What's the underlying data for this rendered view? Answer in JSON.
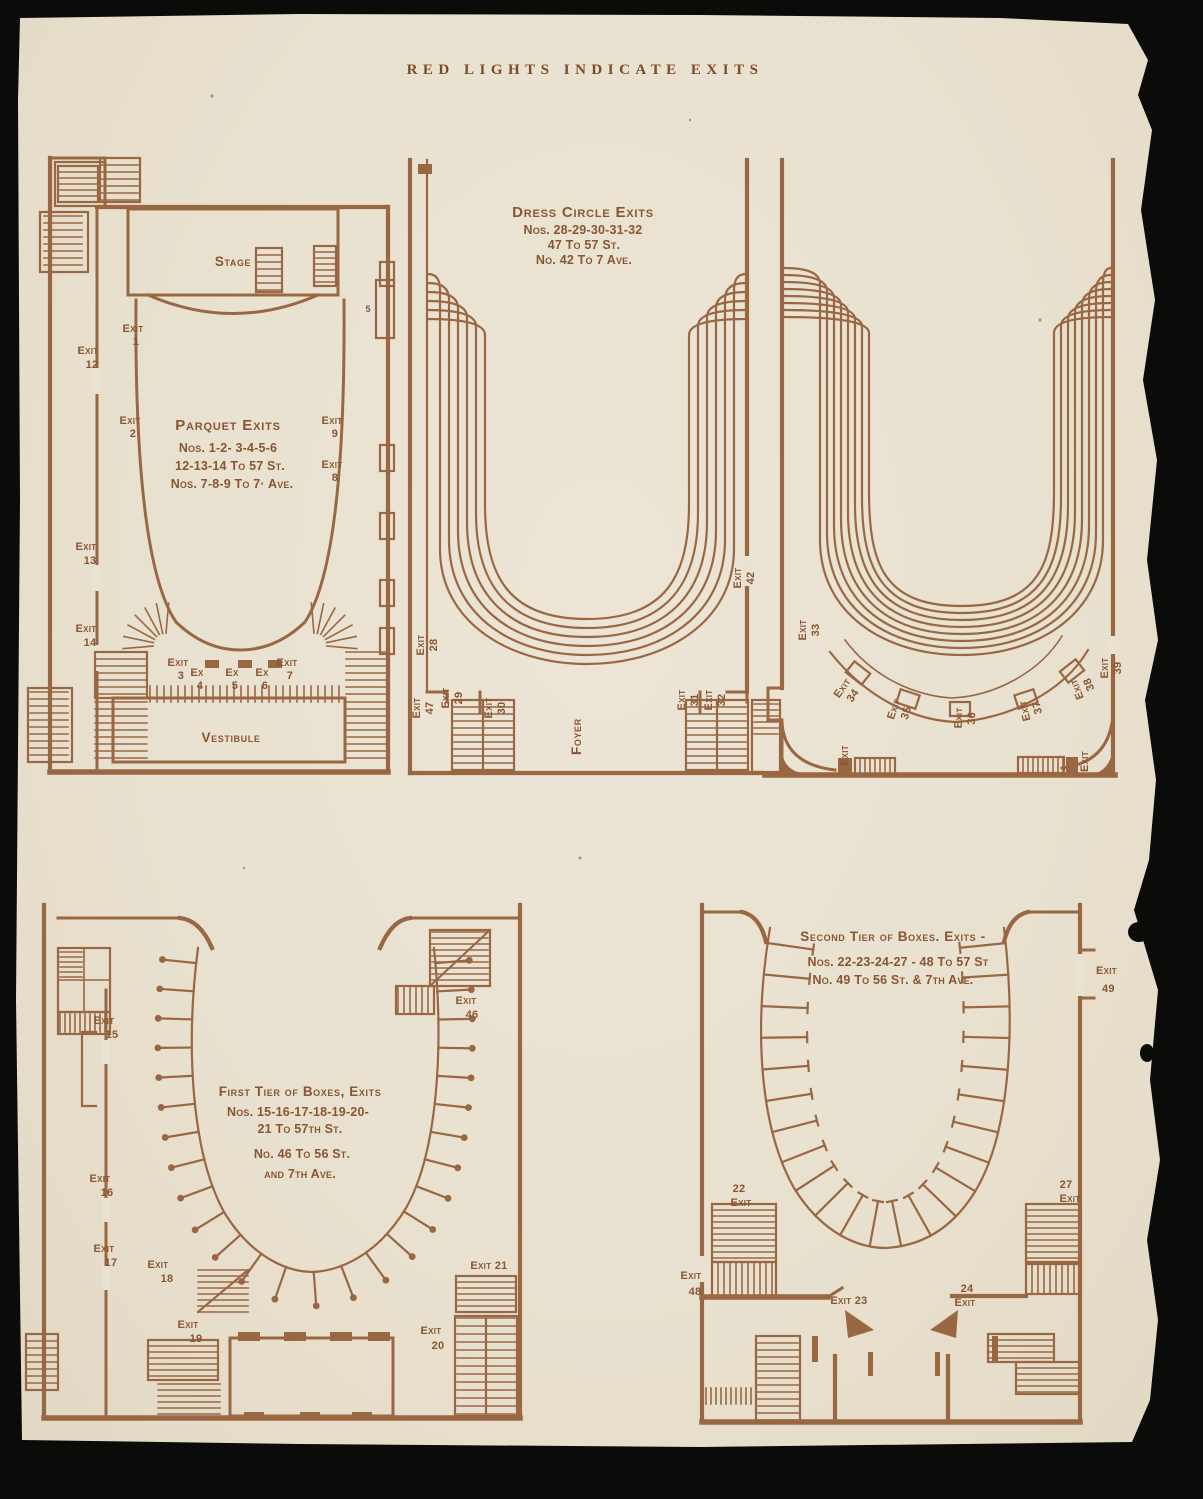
{
  "colors": {
    "ink": "#9a6743",
    "ink_dark": "#8a5531",
    "paper": "#eae2d0",
    "background": "#0b0b0a"
  },
  "heading": "RED LIGHTS INDICATE EXITS",
  "plans": {
    "parquet": {
      "stage": "Stage",
      "vestibule": "Vestibule",
      "door": "5",
      "title": "Parquet Exits",
      "line1": "Nos. 1-2- 3-4-5-6",
      "line2": "12-13-14 To 57 St.",
      "line3": "Nos. 7-8-9 To 7· Ave.",
      "exits": {
        "e1": {
          "w": "Exit",
          "n": "1"
        },
        "e2": {
          "w": "Exit",
          "n": "2"
        },
        "e3": {
          "w": "Exit",
          "n": "3"
        },
        "e4": {
          "w": "Ex",
          "n": "4"
        },
        "e5": {
          "w": "Ex",
          "n": "5"
        },
        "e6": {
          "w": "Ex",
          "n": "6"
        },
        "e7": {
          "w": "Exit",
          "n": "7"
        },
        "e8": {
          "w": "Exit",
          "n": "8"
        },
        "e9": {
          "w": "Exit",
          "n": "9"
        },
        "e12": {
          "w": "Exit",
          "n": "12"
        },
        "e13": {
          "w": "Exit",
          "n": "13"
        },
        "e14": {
          "w": "Exit",
          "n": "14"
        }
      }
    },
    "dress_circle": {
      "title": "Dress Circle Exits",
      "line1": "Nos. 28-29-30-31-32",
      "line2": "47 To 57 St.",
      "line3": "No. 42 To 7 Ave.",
      "foyer": "Foyer",
      "exits": {
        "e28": {
          "w": "Exit",
          "n": "28"
        },
        "e29": {
          "w": "Exit",
          "n": "29"
        },
        "e30": {
          "w": "Exit",
          "n": "30"
        },
        "e31": {
          "w": "Exit",
          "n": "31"
        },
        "e32": {
          "w": "Exit",
          "n": "32"
        },
        "e42": {
          "w": "Exit",
          "n": "42"
        },
        "e47": {
          "w": "Exit",
          "n": "47"
        }
      }
    },
    "upper_tier": {
      "corner_exit_left": "Exit",
      "corner_exit_right": "Exit",
      "exits": {
        "e33": {
          "w": "Exit",
          "n": "33"
        },
        "e34": {
          "w": "Exit",
          "n": "34"
        },
        "e35": {
          "w": "Exit",
          "n": "35"
        },
        "e36": {
          "w": "Exit",
          "n": "36"
        },
        "e37": {
          "w": "Exit",
          "n": "37"
        },
        "e38": {
          "w": "Exit",
          "n": "38"
        },
        "e39": {
          "w": "Exit",
          "n": "39"
        }
      }
    },
    "first_tier": {
      "title": "First Tier of Boxes, Exits",
      "line1": "Nos. 15-16-17-18-19-20-",
      "line2": "21 To 57th St.",
      "line3": "No. 46 To 56 St.",
      "line4": "and 7th Ave.",
      "exits": {
        "e15": {
          "w": "Exit",
          "n": "15"
        },
        "e16": {
          "w": "Exit",
          "n": "16"
        },
        "e17": {
          "w": "Exit",
          "n": "17"
        },
        "e18": {
          "w": "Exit",
          "n": "18"
        },
        "e19": {
          "w": "Exit",
          "n": "19"
        },
        "e20": {
          "w": "Exit",
          "n": "20"
        },
        "e21": "Exit 21",
        "e46": {
          "w": "Exit",
          "n": "46"
        }
      }
    },
    "second_tier": {
      "title": "Second Tier of Boxes. Exits -",
      "line1": "Nos. 22-23-24-27 - 48 To 57 St",
      "line2": "No. 49 To 56 St. & 7th Ave.",
      "exits": {
        "e22": {
          "w": "Exit",
          "n": "22"
        },
        "e23": "Exit 23",
        "e24": {
          "w": "Exit",
          "n": "24"
        },
        "e27": {
          "w": "Exit",
          "n": "27"
        },
        "e48": {
          "w": "Exit",
          "n": "48"
        },
        "e49": {
          "w": "Exit",
          "n": "49"
        }
      }
    }
  }
}
